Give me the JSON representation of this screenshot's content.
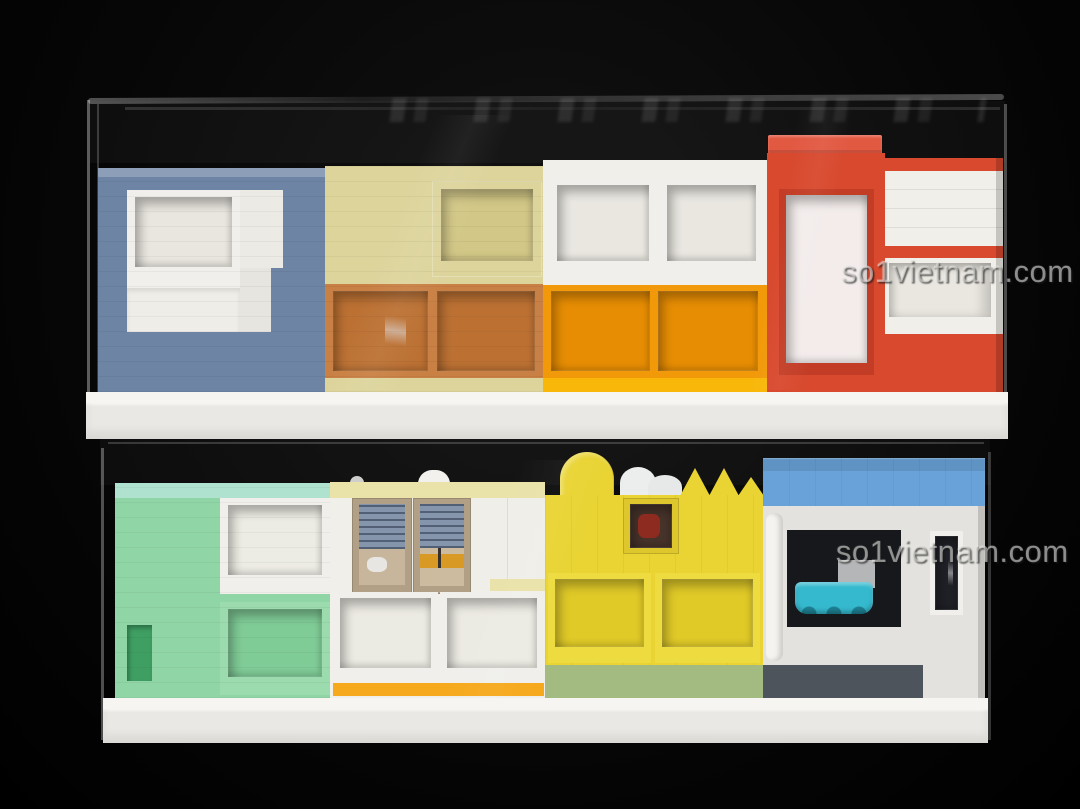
{
  "scene": {
    "type": "photograph",
    "description": "Two stacked clear acrylic display cases, each holding a row of colorful LEGO-built modular storefront facades standing on a white brick base, photographed against a black background",
    "watermark": "so1vietnam.com"
  },
  "colors": {
    "background": "#050505",
    "base_white": "#eae8e4",
    "blue_house": "#6d84a4",
    "tan_house": "#ddd49c",
    "tan_house_window": "#d2c786",
    "tan_house_orange_frame": "#c98044",
    "tan_house_orange": "#bc7133",
    "white_house": "#f1efe9",
    "orange_section": "#f2990a",
    "orange_box": "#e78d04",
    "orange_sill": "#f9b70a",
    "red_house": "#d8492e",
    "red_house_cap": "#e25942",
    "mint_house": "#90d5a6",
    "mint_aqua": "#b0e3cf",
    "mint_box": "#80cc97",
    "mint_door": "#3f9f63",
    "cream_stripe": "#e9e2a9",
    "cream_tan_frame": "#b2a086",
    "blinds_blue": "#8495ac",
    "cream_orange_stripe": "#f6a91d",
    "yellow_house": "#e9d434",
    "yellow_box": "#e0ca28",
    "yellow_sage": "#a3bb81",
    "blue_roof": "#68a2d8",
    "gray_wall": "#e3e2de",
    "dark_window": "#17181c",
    "teal_boat": "#35b9ce",
    "dark_gray_stripe": "#4d545c",
    "white_panel": "#f0efeb"
  },
  "cases": [
    {
      "id": "top",
      "facades": [
        "blue-house",
        "tan-house",
        "white-orange-house",
        "red-tower-house",
        "white-red-house"
      ]
    },
    {
      "id": "bottom",
      "facades": [
        "mint-green-house",
        "cream-tan-house",
        "yellow-arch-house",
        "blue-roof-house"
      ]
    }
  ]
}
